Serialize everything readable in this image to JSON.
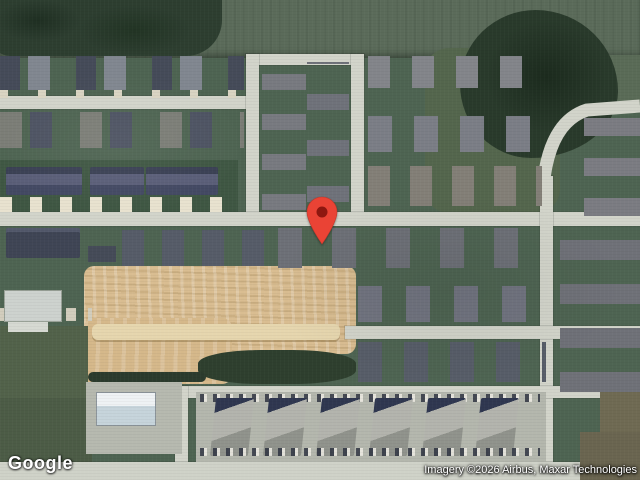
{
  "map": {
    "view": "satellite",
    "provider_logo": "Google",
    "attribution": "Imagery ©2026 Airbus, Maxar Technologies",
    "marker": {
      "label": "location-pin",
      "color": "#EA4335",
      "dot_color": "#8E1710",
      "outline_color": "#C0392B"
    },
    "palette": {
      "lawn": "#4e6452",
      "field": "#5b6b5a",
      "trees": "#2d3e30",
      "road": "#d2d4ca",
      "construction_dirt": "#d9bd91",
      "roof_gray": "#7b7e86",
      "roof_dark": "#3f4555",
      "parking": "#b4b7ad"
    }
  }
}
